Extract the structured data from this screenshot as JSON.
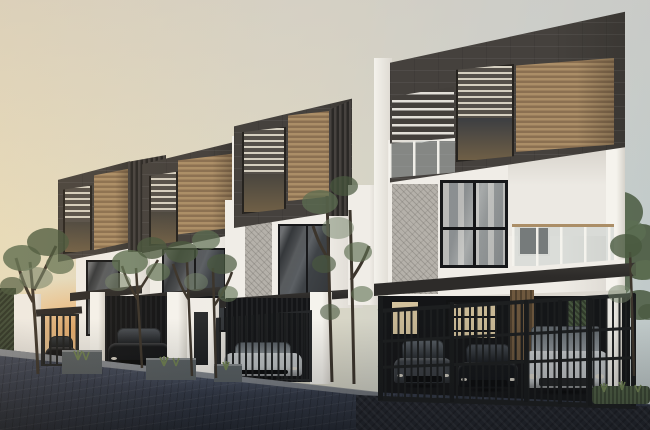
{
  "scene": {
    "type": "architectural-exterior-render",
    "description": "Row of four modern three-storey townhouses at dusk. Dark charcoal cantilevered top boxes with wood-slat panels and louvred windows sit over white lower floors with black-framed glazing and glass balconies. Ground level has carports with parked cars behind vertical-bar metal gates, slim trees, grass planters and a blue-grey paved driveway. Warm sunset glow on the left, pale blue sky on the right.",
    "objects": [
      "sky",
      "sunset-glow",
      "townhouse-units",
      "charcoal-roof-boxes",
      "wood-panels",
      "louvre-windows",
      "glass-balconies",
      "pergola",
      "carports",
      "metal-gates",
      "cars",
      "trees",
      "hedge",
      "planters",
      "driveway",
      "curb"
    ]
  },
  "colors": {
    "sky_left": "#e9dfbf",
    "sky_top": "#cfccc5",
    "sky_right": "#bfc9c9",
    "sunset_glow": "#f0a95f",
    "charcoal": "#45413d",
    "fascia_dark": "#2d2b29",
    "wood_light": "#ab8e67",
    "wood_dark": "#8b7051",
    "white_wall": "#f0ede7",
    "wall_shade": "#d9d5ce",
    "glass_dark": "#35383b",
    "carport": "#141517",
    "gate_metal": "#1e2021",
    "driveway_light": "#4e5566",
    "driveway_dark": "#262b35",
    "curb": "#9fa2a5",
    "marble": "#b5b1aa",
    "lit_window": "#d3c29c",
    "door_wood": "#6e583e",
    "hedge": "#3f4b38",
    "tree_green": "#5d6f52",
    "tree_dark": "#49593f",
    "tree_light": "#74846a",
    "trunk": "#3c352c",
    "grass": "#6f8152",
    "planter": "#596063",
    "car_dark": "#141619",
    "car_gray": "#3c4045",
    "car_silver": "#c7cbcd"
  }
}
